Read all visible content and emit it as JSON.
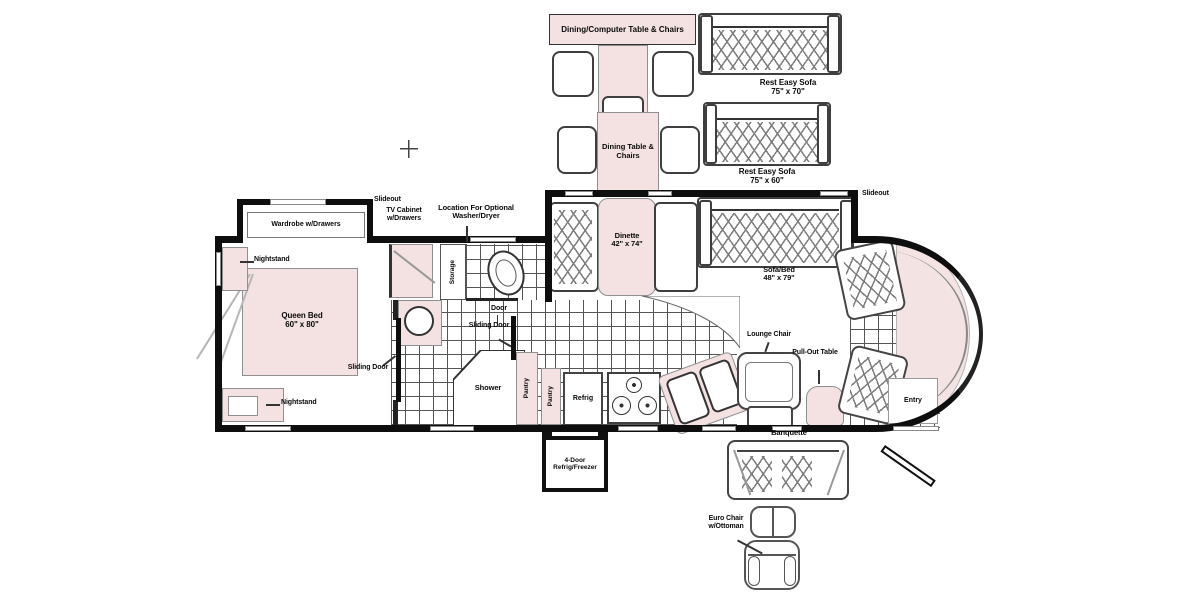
{
  "top_items": {
    "dining_computer": {
      "label": "Dining/Computer Table & Chairs"
    },
    "dining_table": {
      "label": "Dining Table & Chairs"
    },
    "sofa_upper": {
      "name": "Rest Easy Sofa",
      "size": "75\" x 70\""
    },
    "sofa_lower": {
      "name": "Rest Easy Sofa",
      "size": "75\" x 60\""
    }
  },
  "bedroom": {
    "wardrobe": "Wardrobe w/Drawers",
    "nightstand_top": "Nightstand",
    "nightstand_bottom": "Nightstand",
    "bed_name": "Queen Bed",
    "bed_size": "60\" x 80\"",
    "sliding_door": "Sliding Door"
  },
  "bath": {
    "slideout": "Slideout",
    "tv_cabinet": "TV Cabinet w/Drawers",
    "washer_dryer": "Location For Optional Washer/Dryer",
    "storage": "Storage",
    "door": "Door",
    "sliding_door": "Sliding Door",
    "shower": "Shower",
    "pantry_left": "Pantry",
    "pantry_right": "Pantry"
  },
  "kitchen": {
    "refrig": "Refrig",
    "refrig_option": "4-Door Refrig/Freezer"
  },
  "living": {
    "dinette_name": "Dinette",
    "dinette_size": "42\" x 74\"",
    "sofa_bed_name": "Sofa/Bed",
    "sofa_bed_size": "48\" x 79\"",
    "slideout": "Slideout",
    "lounge_chair": "Lounge Chair",
    "pull_out_table": "Pull-Out Table",
    "entry": "Entry"
  },
  "options_bottom": {
    "banquette": "Banquette",
    "euro_chair": "Euro Chair w/Ottoman"
  }
}
